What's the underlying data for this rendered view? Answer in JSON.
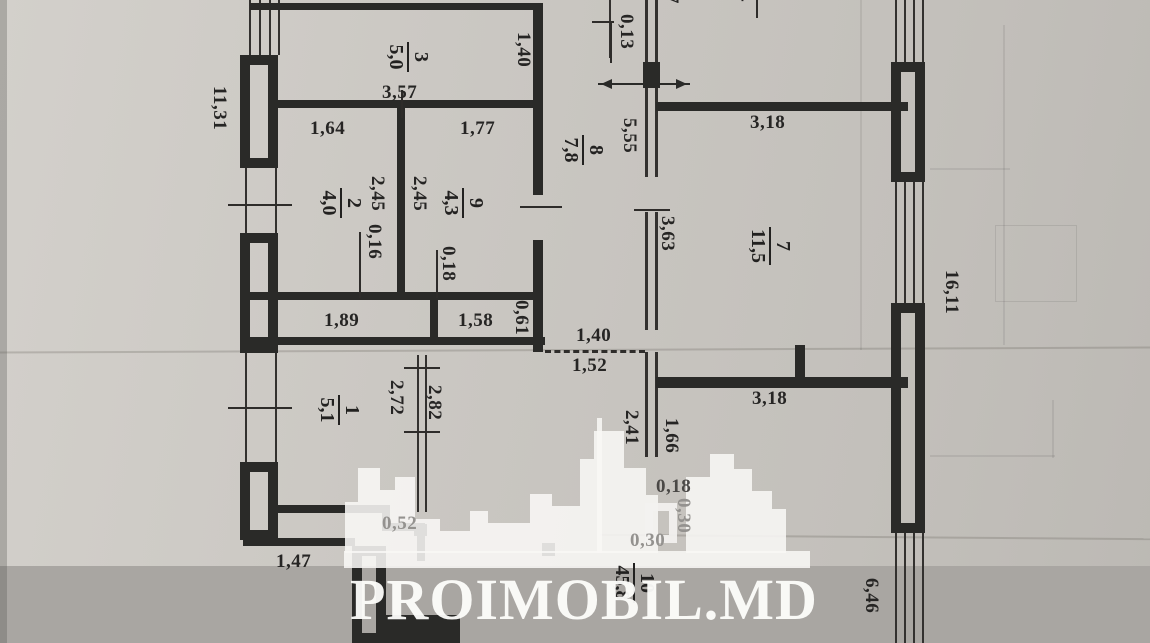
{
  "watermark": {
    "brand": "PROIMOBIL.MD"
  },
  "rooms": [
    {
      "num": "1",
      "area": "5,1"
    },
    {
      "num": "2",
      "area": "4,0"
    },
    {
      "num": "3",
      "area": "5,0"
    },
    {
      "num": "7",
      "area": "11,5"
    },
    {
      "num": "8",
      "area": "7,8"
    },
    {
      "num": "9",
      "area": "4,3"
    },
    {
      "num": "10",
      "area": "45,8"
    }
  ],
  "dims": [
    {
      "text": "11,31"
    },
    {
      "text": "3,57"
    },
    {
      "text": "1,40"
    },
    {
      "text": "1,64"
    },
    {
      "text": "1,77"
    },
    {
      "text": "2,45"
    },
    {
      "text": "2,45"
    },
    {
      "text": "0,16"
    },
    {
      "text": "0,18"
    },
    {
      "text": "1,89"
    },
    {
      "text": "1,58"
    },
    {
      "text": "0,61"
    },
    {
      "text": "1,40"
    },
    {
      "text": "1,52"
    },
    {
      "text": "2,72"
    },
    {
      "text": "2,82"
    },
    {
      "text": "1,47"
    },
    {
      "text": "0,52"
    },
    {
      "text": "0,13"
    },
    {
      "text": "5,55"
    },
    {
      "text": "3,18"
    },
    {
      "text": "3,63"
    },
    {
      "text": "3,18"
    },
    {
      "text": "1,66"
    },
    {
      "text": "2,41"
    },
    {
      "text": "0,18"
    },
    {
      "text": "0,30"
    },
    {
      "text": "0,30"
    },
    {
      "text": "16,11"
    },
    {
      "text": "6,46"
    },
    {
      "text": "7"
    },
    {
      "text": "4"
    }
  ]
}
